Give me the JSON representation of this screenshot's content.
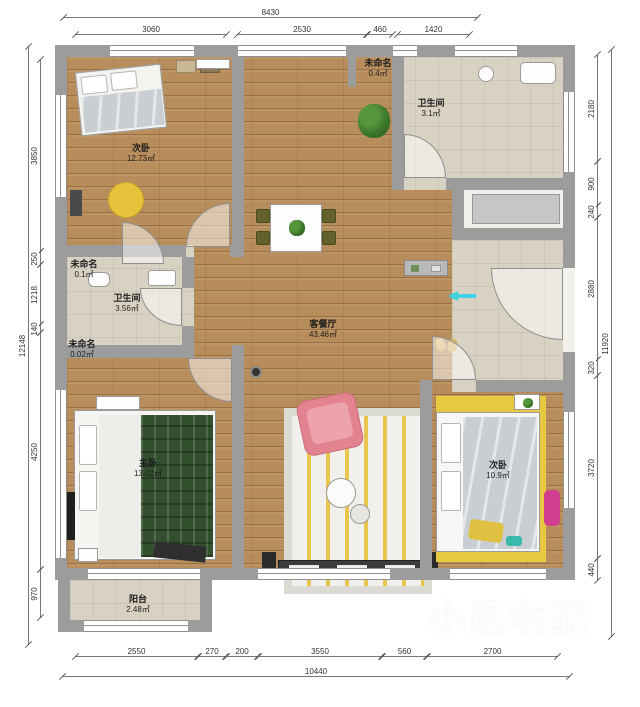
{
  "rooms": {
    "bedroom_top": {
      "name": "次卧",
      "area": "12.73㎡"
    },
    "unnamed_top": {
      "name": "未命名",
      "area": "0.4㎡"
    },
    "bath_top": {
      "name": "卫生间",
      "area": "3.1㎡"
    },
    "unnamed_mid": {
      "name": "未命名",
      "area": "0.1㎡"
    },
    "bath_mid": {
      "name": "卫生间",
      "area": "3.56㎡"
    },
    "unnamed_small": {
      "name": "未命名",
      "area": "0.02㎡"
    },
    "living": {
      "name": "客餐厅",
      "area": "43.46㎡"
    },
    "master": {
      "name": "主卧",
      "area": "13.02㎡"
    },
    "bedroom_right": {
      "name": "次卧",
      "area": "10.9㎡"
    },
    "balcony": {
      "name": "阳台",
      "area": "2.48㎡"
    }
  },
  "dims": {
    "top": {
      "total": "8430",
      "s": [
        "3060",
        "2530",
        "460",
        "1420"
      ]
    },
    "bottom": {
      "total": "10440",
      "s": [
        "2550",
        "270",
        "200",
        "3550",
        "560",
        "2700"
      ]
    },
    "left": {
      "total": "12148",
      "s": [
        "3850",
        "250",
        "1218",
        "140",
        "4250",
        "970"
      ]
    },
    "right": {
      "total": "11920",
      "s": [
        "2180",
        "900",
        "240",
        "2880",
        "320",
        "3720",
        "440"
      ]
    }
  },
  "watermark": {
    "text": "小尼宅配"
  },
  "colors": {
    "wall": "#9c9c9c",
    "wood": "#b78d5b",
    "tile": "#d8d2c3",
    "accent_yellow": "#e7c83e",
    "sofa_pink": "#e2838f",
    "plaid_green": "#32502e",
    "entry_arrow": "#3fd2e4",
    "magenta_chair": "#cf3f8d"
  }
}
